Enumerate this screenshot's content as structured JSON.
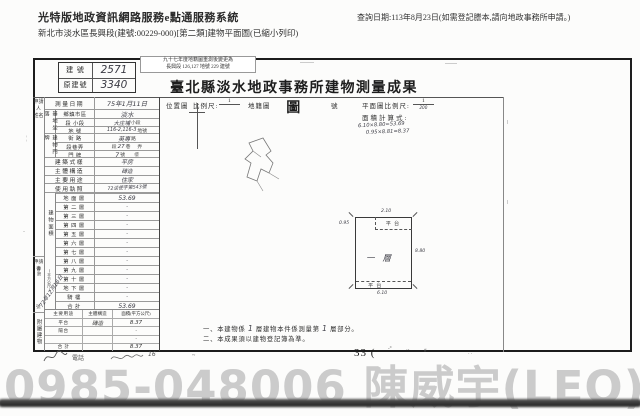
{
  "header": {
    "system_title": "光特版地政資訊網路服務e點通服務系統",
    "subtitle": "新北市淡水區長興段(建號:00229-000)[第二類]建物平面圖(已縮小列印)",
    "query_date": "查詢日期:113年8月23日(如需登記謄本,請向地政事務所申請。)"
  },
  "doc": {
    "title": "臺北縣淡水地政事務所建物測量成果圖",
    "stamp": {
      "line1": "九十七年度地籍圖重測後變更為",
      "line2": "長興段 126,127 地號 229 建號"
    },
    "building_no": {
      "label": "建 號",
      "value": "2571"
    },
    "orig_no": {
      "label": "原建號",
      "value": "3340"
    },
    "applicant": {
      "label": "申請人",
      "sub": "姓名"
    },
    "survey": {
      "label": "測量日期",
      "value": "75年1月11日"
    },
    "site": {
      "group": "基地坐落",
      "district": {
        "label": "鄉鎮市區",
        "value": "淡水"
      },
      "section": {
        "label": "段 小段",
        "hw": "大庄埔",
        "suffix": "小段"
      },
      "parcel": {
        "label": "地 號",
        "hw": "116-2,116-3",
        "suffix": "地號"
      }
    },
    "address": {
      "group": "建物門牌",
      "street": {
        "label": "街 路",
        "hw": "英專",
        "suffix": "路"
      },
      "lane": {
        "label": "段巷弄",
        "p1": "段",
        "hw": "27",
        "p2": "巷",
        "p3": "弄"
      },
      "door": {
        "label": "門 牌",
        "hw": "7",
        "suffix": "號",
        "suffix2": "樓"
      }
    },
    "style": {
      "label": "建築式樣",
      "value": "平房"
    },
    "structure": {
      "label": "主體構造",
      "value": "磚造"
    },
    "usage": {
      "label": "主要用途",
      "value": "住家"
    },
    "license": {
      "label": "使用執照",
      "value": "72淡使字第543號"
    },
    "area_group": {
      "label": "建物面積",
      "unit": "(平方公尺)"
    },
    "floors": [
      {
        "label": "地面層",
        "value": "53.69"
      },
      {
        "label": "第二層",
        "value": "·"
      },
      {
        "label": "第三層",
        "value": "·"
      },
      {
        "label": "第四層",
        "value": "·"
      },
      {
        "label": "第五層",
        "value": "·"
      },
      {
        "label": "第六層",
        "value": "·"
      },
      {
        "label": "第七層",
        "value": "·"
      },
      {
        "label": "第八層",
        "value": "·"
      },
      {
        "label": "第九層",
        "value": "·"
      },
      {
        "label": "第十層",
        "value": "·"
      },
      {
        "label": "地下層",
        "value": "·"
      },
      {
        "label": "騎樓",
        "value": "·"
      },
      {
        "label": "合計",
        "value": "53.69"
      }
    ],
    "application": {
      "label": "申請書",
      "no_prefix": "字第",
      "no_suffix": "號",
      "date": "72年12月16日"
    },
    "annex": {
      "group": "附屬建物",
      "headers": {
        "use": "主要用途",
        "struct": "主體構造",
        "area": "面積(平方公尺)"
      },
      "rows": [
        {
          "use": "平台",
          "struct": "磚造",
          "area": "8.37"
        },
        {
          "use": "陽台",
          "struct": "",
          "area": "·"
        },
        {
          "use": "",
          "struct": "",
          "area": "·"
        },
        {
          "use": "合 計",
          "struct": "",
          "area": "8.37"
        }
      ]
    },
    "drawing": {
      "loc_label": "位置圖",
      "scale_label": "比例尺:",
      "scale_num": "1",
      "cadastre_label": "地籍圖",
      "no_label": "號",
      "plan_scale_label": "平面圖比例尺:",
      "plan_num": "1",
      "plan_den": "200",
      "calc_label": "面積計算式:",
      "calc1": "6.10×8.80=53.69",
      "calc2": "0.95×8.81=8.37",
      "plan": {
        "room": "一層",
        "terrace_top": "平台",
        "terrace_bottom": "平台",
        "dim_top": "2.10",
        "dim_left": "0.95",
        "dim_right": "8.80",
        "dim_bottom": "6.10"
      }
    },
    "notes": {
      "n1a": "一、本建物係",
      "n1b": "1",
      "n1c": "層建物本件係測量第",
      "n1d": "1",
      "n1e": "層部分。",
      "n2": "二、本成果須以建物登記簿為準。"
    }
  },
  "footer": {
    "page_stamp": "33 (",
    "phone_label": "電話",
    "num_mark": "16",
    "tilde": "~",
    "tick1": "-°",
    "tick2": "·-",
    "hash": "#",
    "dots": "· ·",
    "watermark": "0985-048006 陳威宇(LEO)"
  }
}
